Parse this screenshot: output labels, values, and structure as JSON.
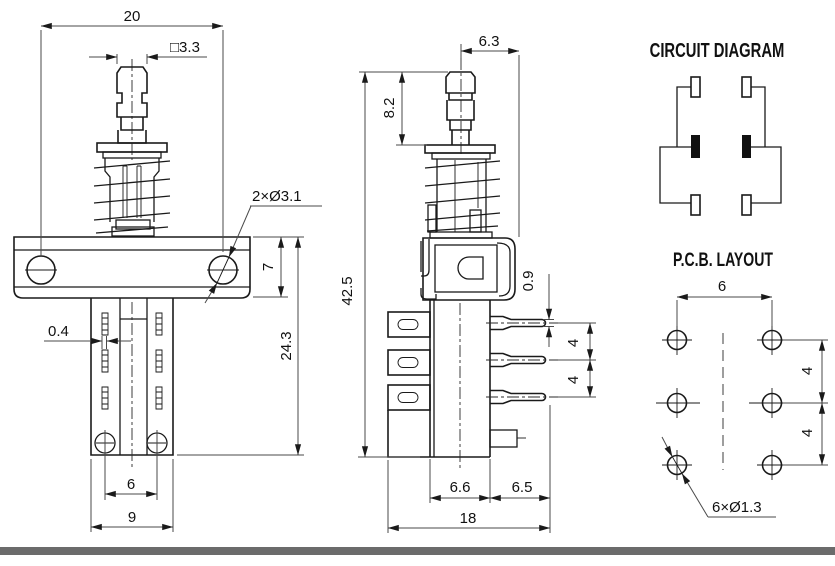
{
  "front_view": {
    "dim_mount_hole_spacing": "20",
    "dim_plunger_square": "□3.3",
    "dim_mount_holes": "2×Ø3.1",
    "dim_bracket_height": "7",
    "dim_body_height": "24.3",
    "dim_terminal_thickness": "0.4",
    "dim_bottom_hole_spacing": "6",
    "dim_body_width": "9"
  },
  "side_view": {
    "dim_center_to_edge": "6.3",
    "dim_plunger_height": "8.2",
    "dim_total_height": "42.5",
    "dim_pin_thickness": "0.9",
    "dim_pin_pitch_1": "4",
    "dim_pin_pitch_2": "4",
    "dim_body_depth": "6.6",
    "dim_pin_length": "6.5",
    "dim_total_depth": "18"
  },
  "circuit_diagram": {
    "title": "CIRCUIT DIAGRAM"
  },
  "pcb_layout": {
    "title": "P.C.B. LAYOUT",
    "dim_column_spacing": "6",
    "dim_row_spacing_1": "4",
    "dim_row_spacing_2": "4",
    "dim_hole_callout": "6×Ø1.3"
  },
  "footer": {
    "bar_color": "#6b6b6b"
  }
}
